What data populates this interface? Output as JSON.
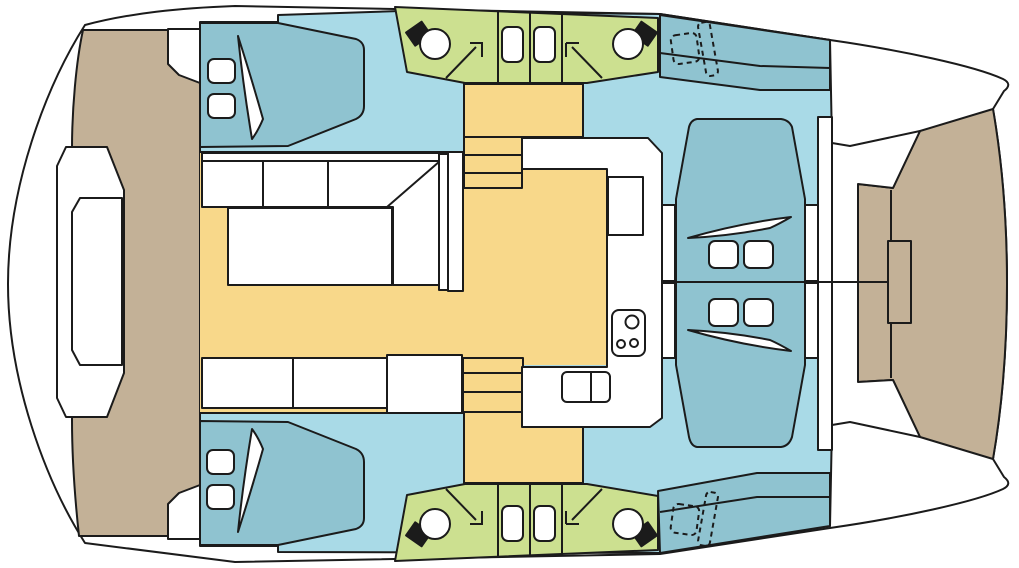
{
  "diagram": {
    "kind": "catamaran-deck-plan",
    "orientation": "bow-right-stern-left",
    "areas": {
      "aft_cockpit": "aft cockpit with bench seat",
      "salon": "salon with U-sofa, table and C-shaped galley",
      "galley": "galley with stove, double sink and fridge",
      "port_aft_cabin": "double berth cabin",
      "starboard_aft_cabin": "double berth cabin",
      "forward_berths": "two forward double berths head-to-head",
      "port_bathroom": "bathroom with toilet, shower and washbasin",
      "starboard_bathroom": "bathroom with toilet, shower and washbasin",
      "foredeck": "foredeck with anchor locker hatch",
      "companionways": "stairs and hull corridors"
    },
    "counts": {
      "double_berths": 4,
      "bathrooms": 2,
      "toilets": 4,
      "washbasins": 4,
      "showers": 4,
      "pillows": 8
    }
  },
  "colors": {
    "outline": "#1b1b1b",
    "hull": "#ffffff",
    "deck": "#c3b197",
    "interior": "#a9dae7",
    "furniture": "#8fc3d0",
    "bathroom": "#cce090",
    "salon": "#f8d88a",
    "fixture": "#1b1b1b"
  }
}
